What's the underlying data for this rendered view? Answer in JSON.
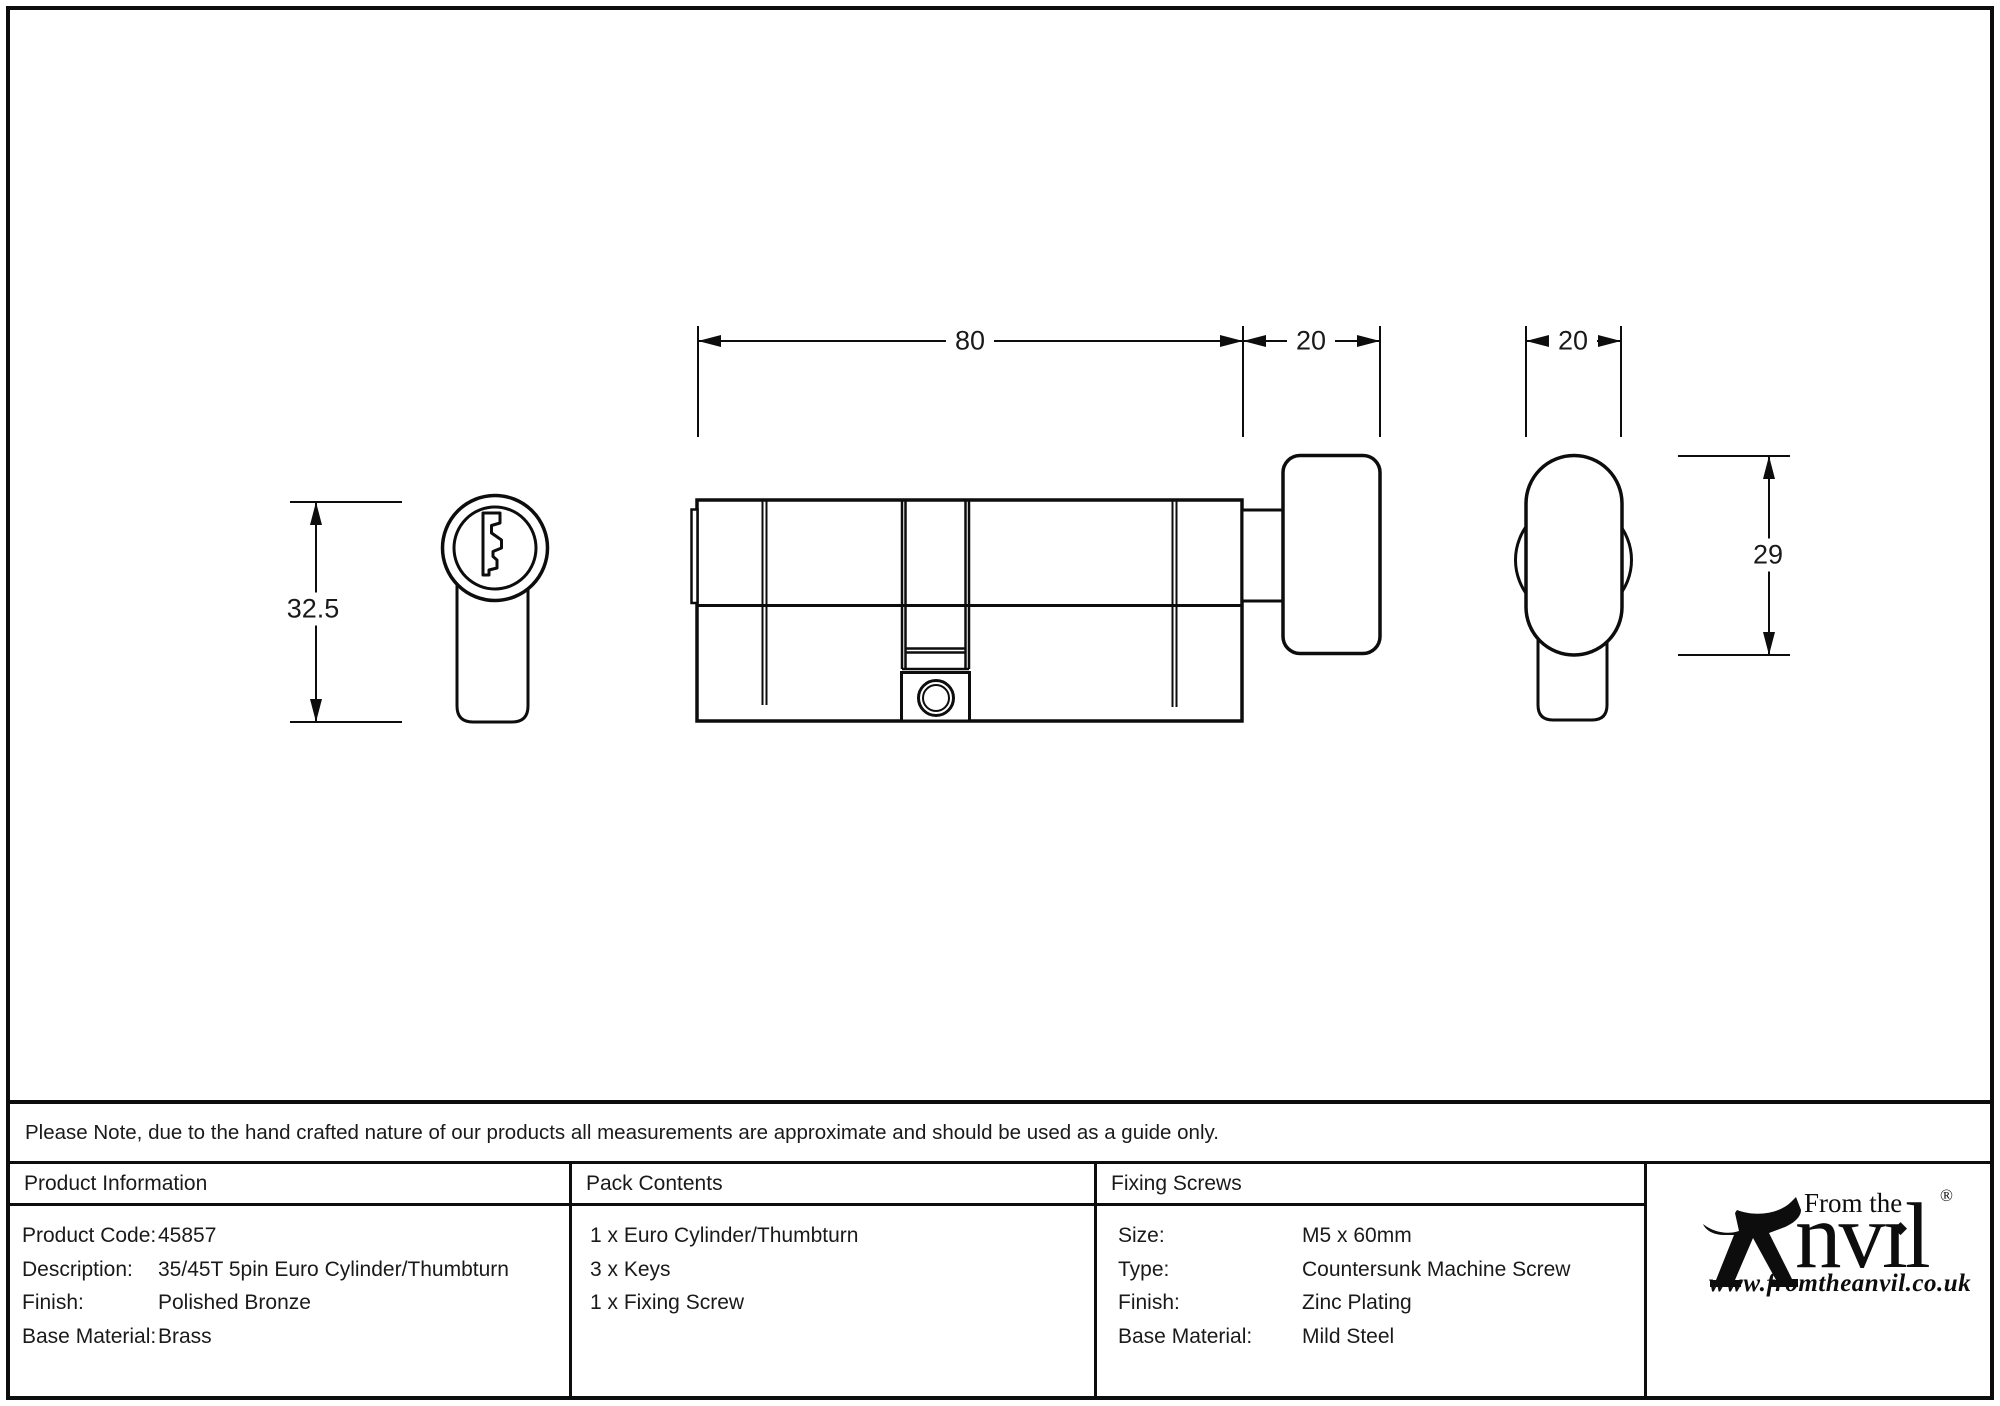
{
  "drawing": {
    "dim_body_length": "80",
    "dim_neck_thumbturn": "20",
    "dim_thumbturn_width": "20",
    "dim_face_height": "32.5",
    "dim_thumbturn_height": "29"
  },
  "note": {
    "text": "Please Note, due to the hand crafted nature of our products all measurements are approximate and should be used as a guide only."
  },
  "product_info": {
    "header": "Product Information",
    "rows": [
      {
        "label": "Product Code:",
        "value": "45857"
      },
      {
        "label": "Description:",
        "value": "35/45T 5pin Euro Cylinder/Thumbturn"
      },
      {
        "label": "Finish:",
        "value": "Polished Bronze"
      },
      {
        "label": "Base Material:",
        "value": "Brass"
      }
    ]
  },
  "pack_contents": {
    "header": "Pack Contents",
    "items": [
      "1 x Euro Cylinder/Thumbturn",
      "3 x Keys",
      "1 x Fixing Screw"
    ]
  },
  "fixing_screws": {
    "header": "Fixing Screws",
    "rows": [
      {
        "label": "Size:",
        "value": "M5 x 60mm"
      },
      {
        "label": "Type:",
        "value": "Countersunk Machine Screw"
      },
      {
        "label": "Finish:",
        "value": "Zinc Plating"
      },
      {
        "label": "Base Material:",
        "value": "Mild Steel"
      }
    ]
  },
  "brand": {
    "tagline": "From the",
    "name_suffix": "nvıl",
    "registered": "®",
    "diamond": "◆",
    "url": "www.fromtheanvil.co.uk"
  }
}
